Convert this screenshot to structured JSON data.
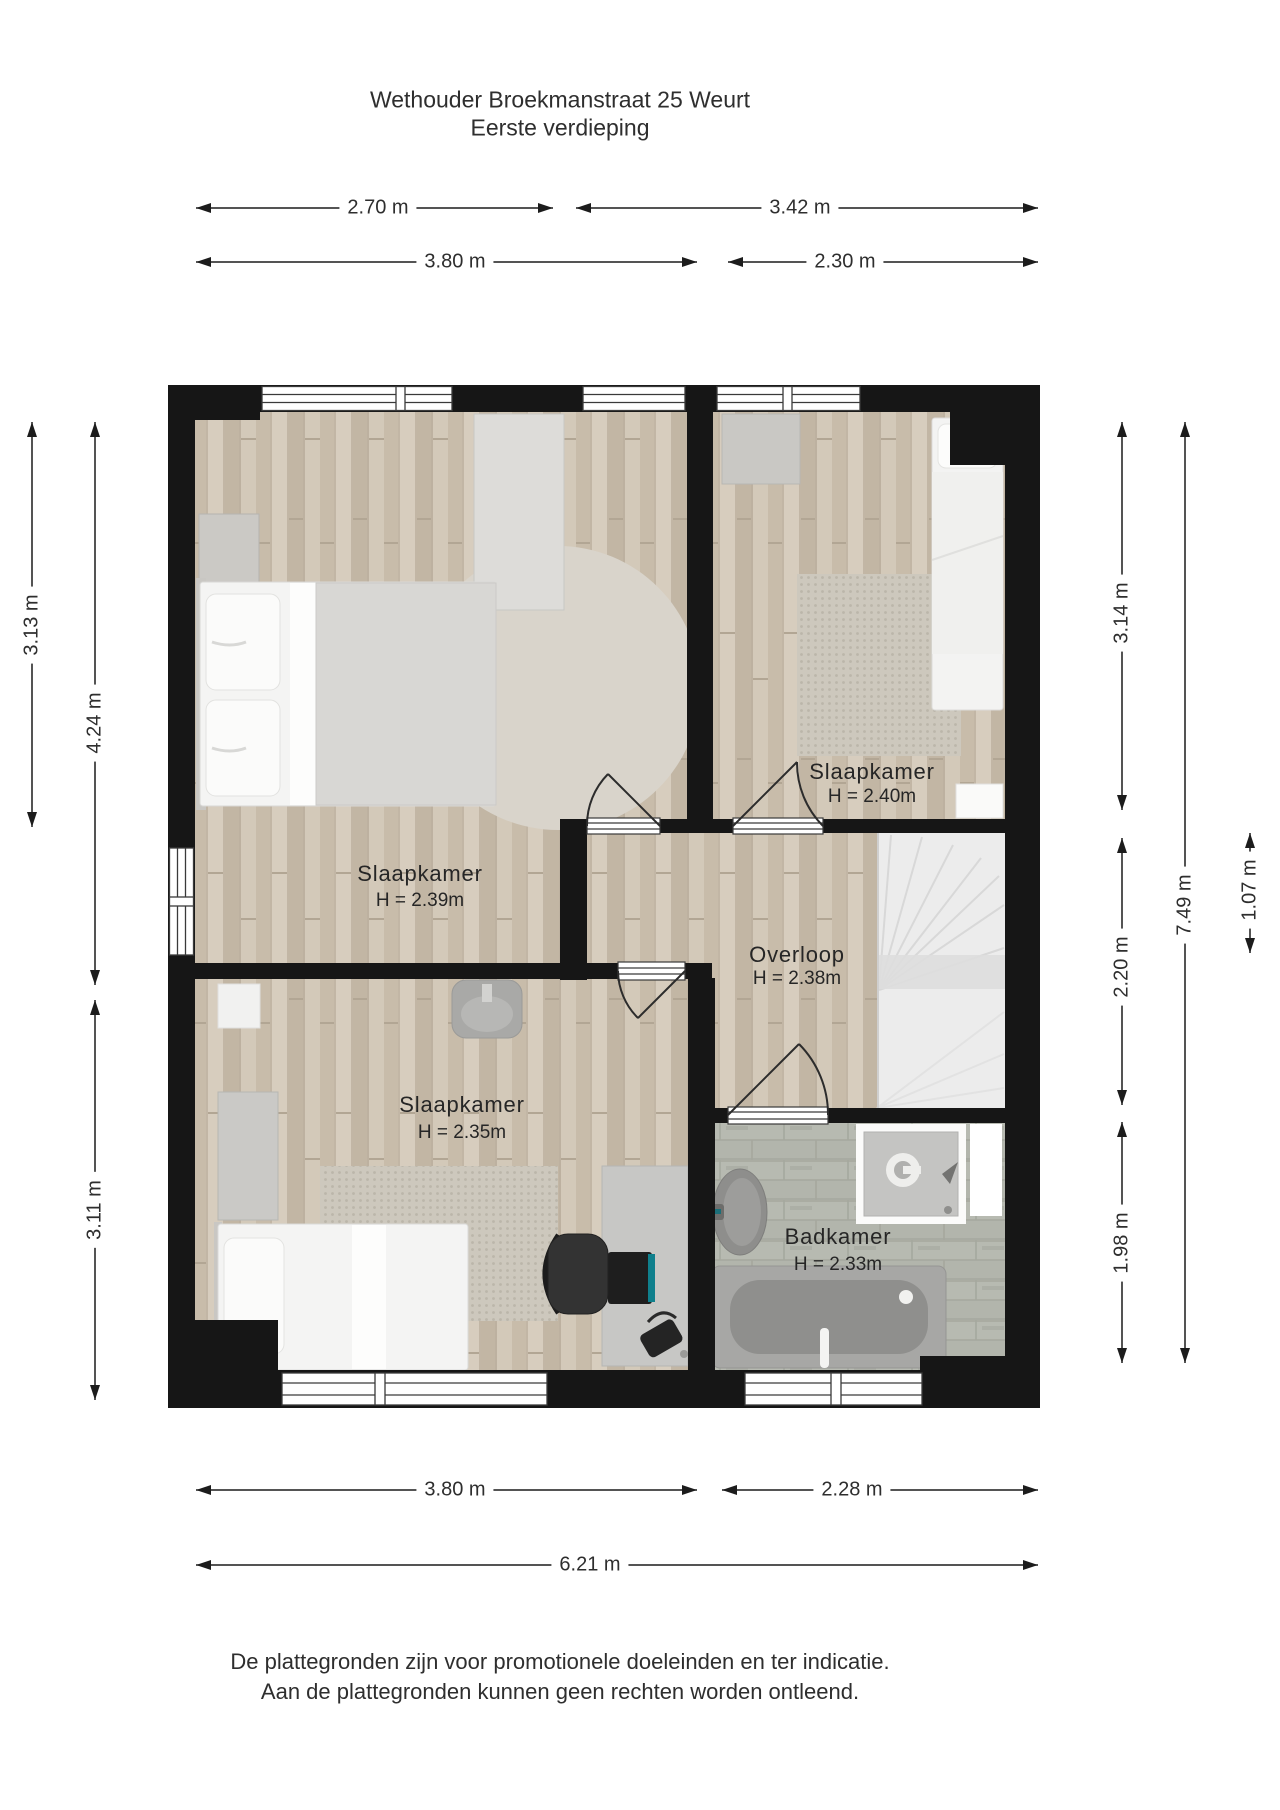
{
  "title": {
    "line1": "Wethouder Broekmanstraat 25 Weurt",
    "line2": "Eerste verdieping"
  },
  "rooms": {
    "bedroom_main": {
      "name": "Slaapkamer",
      "height": "H = 2.39m"
    },
    "bedroom_right": {
      "name": "Slaapkamer",
      "height": "H = 2.40m"
    },
    "landing": {
      "name": "Overloop",
      "height": "H = 2.38m"
    },
    "bedroom_bottom": {
      "name": "Slaapkamer",
      "height": "H = 2.35m"
    },
    "bathroom": {
      "name": "Badkamer",
      "height": "H = 2.33m"
    }
  },
  "dimensions": {
    "top_row1_left": "2.70 m",
    "top_row1_right": "3.42 m",
    "top_row2_left": "3.80 m",
    "top_row2_right": "2.30 m",
    "left_col1": "3.13 m",
    "left_col2_top": "4.24 m",
    "left_col2_bottom": "3.11 m",
    "right_col1_top": "3.14 m",
    "right_col1_mid": "2.20 m",
    "right_col1_bottom": "1.98 m",
    "right_col2": "7.49 m",
    "right_col3": "1.07 m",
    "bottom_row1_left": "3.80 m",
    "bottom_row1_right": "2.28 m",
    "bottom_total": "6.21 m"
  },
  "footer": {
    "line1": "De plattegronden zijn voor promotionele doeleinden en ter indicatie.",
    "line2": "Aan de plattegronden kunnen geen rechten worden ontleend."
  },
  "colors": {
    "wall": "#161616",
    "wood_floor": "#cfc4b4",
    "tile_floor": "#b6b9b0",
    "stairs": "#ececec",
    "text": "#2e2e2e"
  }
}
